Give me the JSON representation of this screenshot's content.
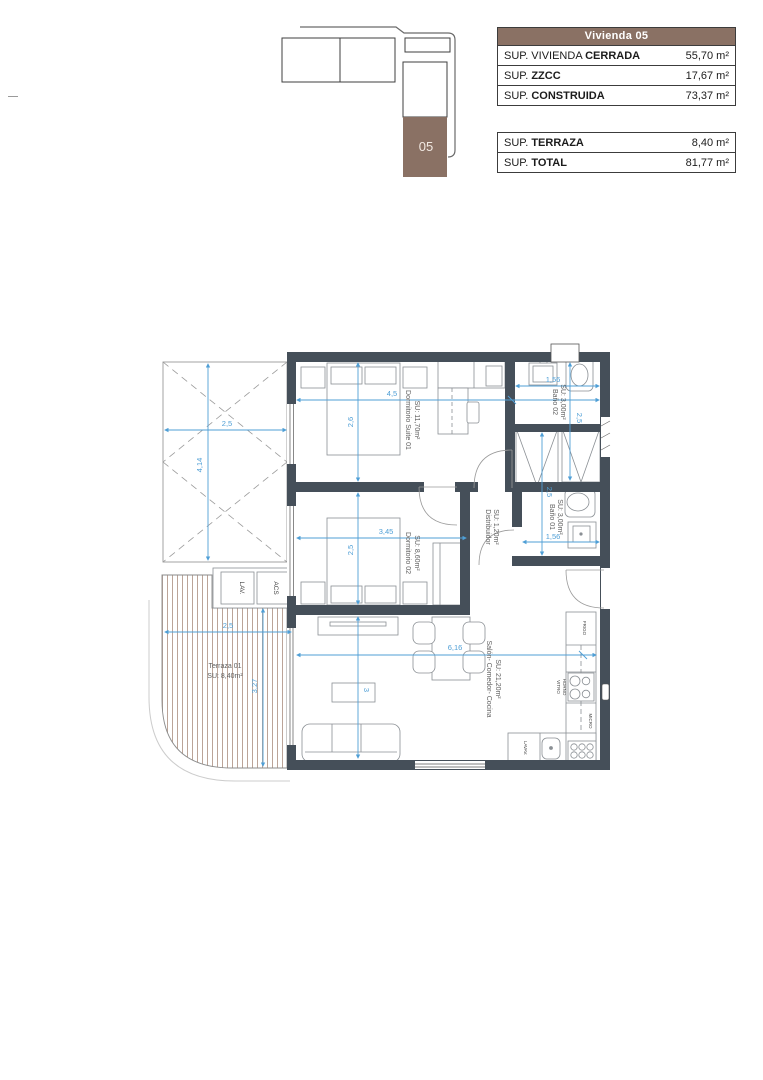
{
  "panel": {
    "title": "Vivienda 05",
    "rows": [
      {
        "prefix": "SUP. VIVIENDA ",
        "bold": "CERRADA",
        "value": "55,70 m²"
      },
      {
        "prefix": "SUP. ",
        "bold": "ZZCC",
        "value": "17,67 m²"
      },
      {
        "prefix": "SUP. ",
        "bold": "CONSTRUIDA",
        "value": "73,37 m²"
      },
      {
        "prefix": "SUP. ",
        "bold": "TERRAZA",
        "value": "8,40 m²"
      },
      {
        "prefix": "SUP. ",
        "bold": "TOTAL",
        "value": "81,77 m²"
      }
    ]
  },
  "keyplan": {
    "unit": "05"
  },
  "rooms": {
    "suite": {
      "name": "Dormitorio Suite 01",
      "area": "SU: 11,70m²"
    },
    "bano02": {
      "name": "Baño 02",
      "area": "SU: 3,00m²"
    },
    "distribuidor": {
      "name": "Distribuidor",
      "area": "SU: 1,20m²"
    },
    "bano01": {
      "name": "Baño 01",
      "area": "SU: 3,00m²"
    },
    "dorm02": {
      "name": "Dormitorio 02",
      "area": "SU: 8,60m²"
    },
    "salon": {
      "name": "Salón- Comedor- Cocina",
      "area": "SU: 21,20m²"
    },
    "terraza": {
      "name": "Terraza 01",
      "area": "SU: 8,40m²"
    }
  },
  "fixtures": {
    "lav": "LAV.",
    "acs": "ACS",
    "frigo": "FRIGO",
    "vitro": "VITRO",
    "horno": "HORNO",
    "micro": "MICRO",
    "lavav": "LAVAV."
  },
  "dims": {
    "pergola_w": "2,5",
    "pergola_h": "4,14",
    "suite_w": "4,5",
    "suite_h": "2,6",
    "bano02_w": "1,56",
    "closets_h": "2,5",
    "dorm02_w": "3,45",
    "dorm02_h": "2,5",
    "bano01_h": "2,5",
    "bano01_w": "1,56",
    "salon_w": "6,16",
    "salon_h": "3",
    "terraza_w": "2,5",
    "terraza_h": "3,27"
  },
  "colors": {
    "brand_brown": "#8a7164",
    "wall": "#454f59",
    "dimension_blue": "#4f9fd6",
    "deck": "#b49a8c"
  }
}
